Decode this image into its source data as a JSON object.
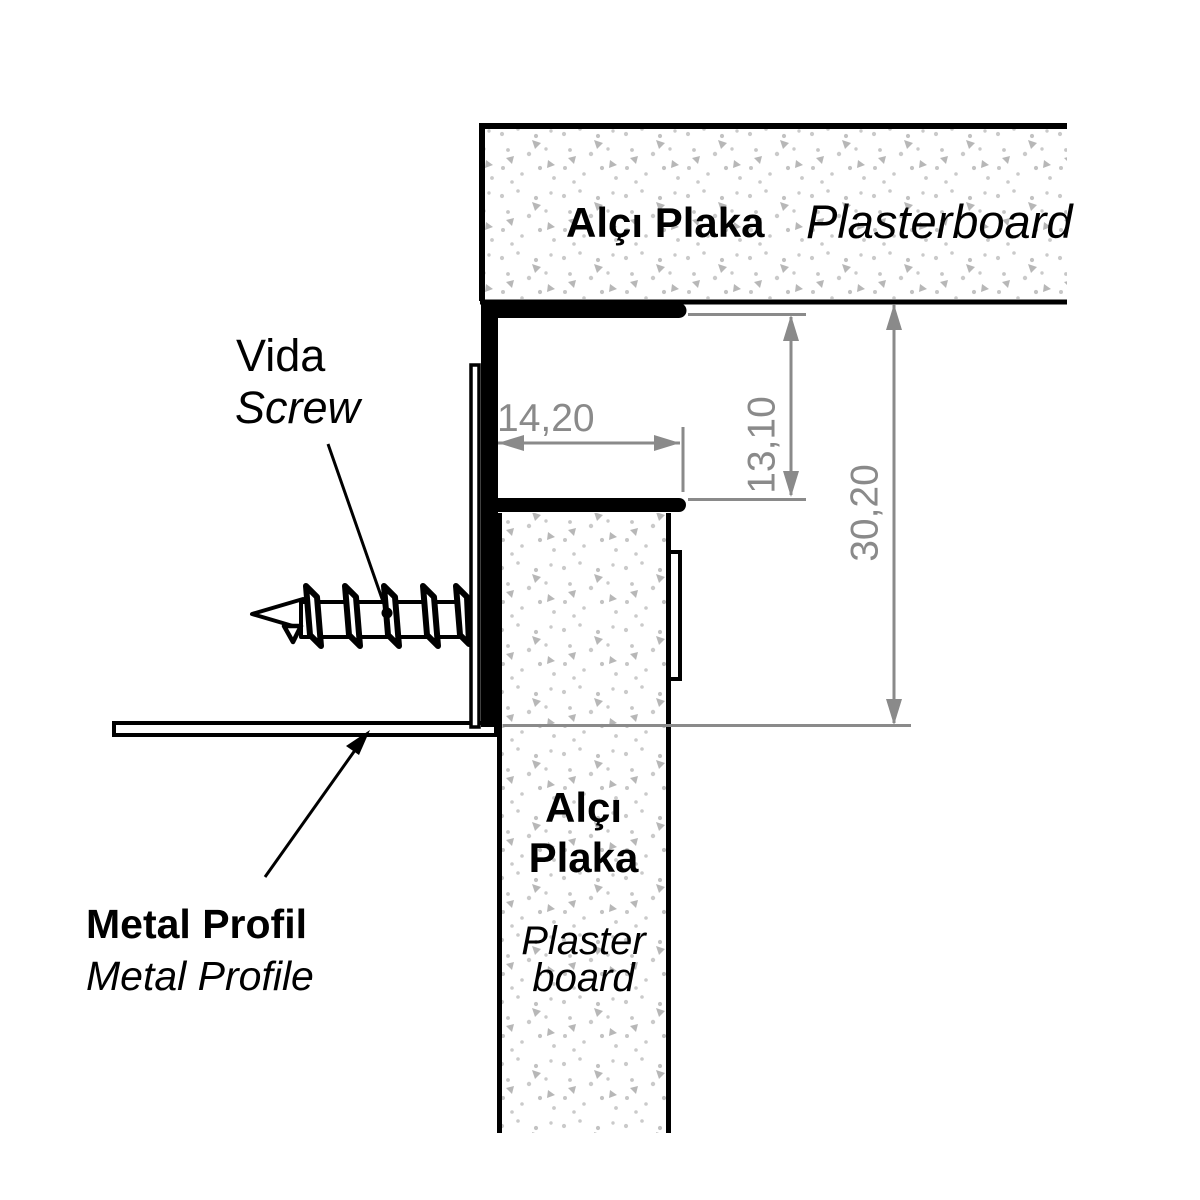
{
  "diagram": {
    "top_board": {
      "label_tr": "Alçı Plaka",
      "label_en": "Plasterboard"
    },
    "bottom_board": {
      "label_tr_line1": "Alçı",
      "label_tr_line2": "Plaka",
      "label_en_line1": "Plaster",
      "label_en_line2": "board"
    },
    "screw": {
      "label_tr": "Vida",
      "label_en": "Screw"
    },
    "metal_profile": {
      "label_tr": "Metal Profil",
      "label_en": "Metal Profile"
    },
    "dimensions": {
      "reveal_depth": "14,20",
      "reveal_height": "13,10",
      "overall_height": "30,20"
    },
    "colors": {
      "line_black": "#000000",
      "dimension_gray": "#8a8a8a",
      "texture_dot_gray": "#cacaca",
      "texture_triangle_gray": "#b7b7b7"
    }
  }
}
